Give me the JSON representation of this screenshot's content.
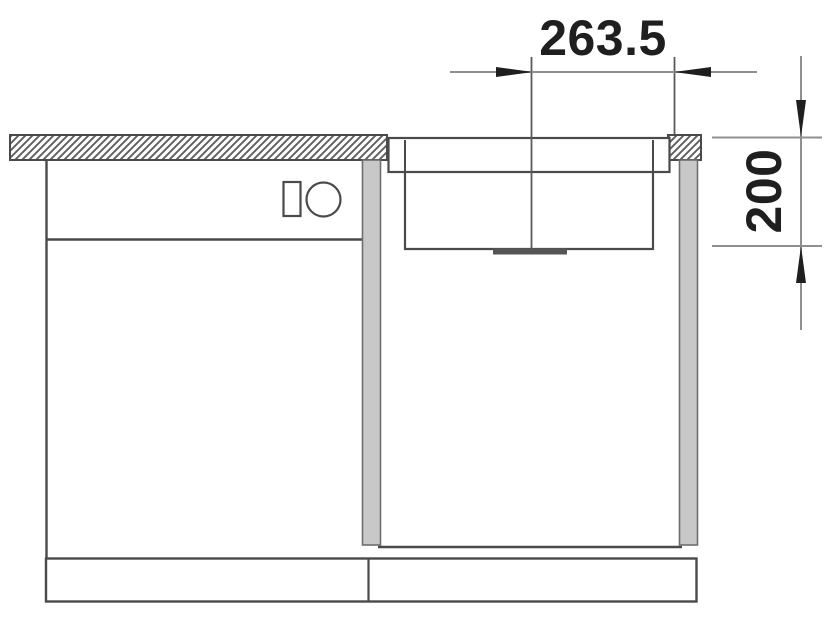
{
  "drawing": {
    "type": "technical-section-drawing",
    "subject": "sink bowl installed in base cabinet beside appliance cabinet, front section view",
    "colors": {
      "line": "#4a4a4a",
      "dimension_line": "#8f8f8f",
      "text_and_arrows": "#1f1f1f",
      "side_panel_fill": "#c8c8c8",
      "hatch": "#5f5f5f",
      "background": "#ffffff"
    },
    "dimensions": {
      "width": {
        "label": "263.5",
        "value": 263.5,
        "orientation": "horizontal"
      },
      "depth": {
        "label": "200",
        "value": 200,
        "orientation": "vertical"
      }
    }
  }
}
